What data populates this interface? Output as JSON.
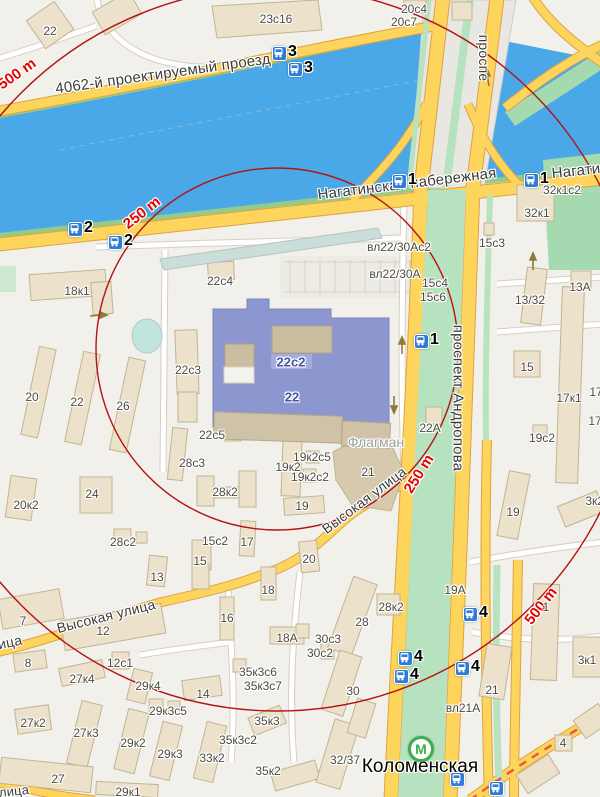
{
  "map": {
    "type": "city-map",
    "colors": {
      "water": "#4aa8e8",
      "land": "#f1f0ea",
      "road_major": "#fdd45c",
      "road_casing": "#dfa243",
      "building": "#ece2cb",
      "highlight_building": "#8d97cf",
      "green_area": "#a5d9af",
      "radius_circle": "#b31312",
      "distance_label": "#e10600",
      "bus_icon": "#2d7cd7",
      "metro_green": "#3aaf4a"
    },
    "metro": {
      "name": "Коломенская",
      "logo_letter": "М",
      "x": 421,
      "y": 749
    },
    "radius_rings_m": [
      250,
      500
    ],
    "bus_stops": [
      {
        "x": 272,
        "y": 46,
        "n": "3"
      },
      {
        "x": 288,
        "y": 62,
        "n": "3"
      },
      {
        "x": 68,
        "y": 222,
        "n": "2"
      },
      {
        "x": 108,
        "y": 235,
        "n": "2"
      },
      {
        "x": 392,
        "y": 174,
        "n": "1"
      },
      {
        "x": 524,
        "y": 173,
        "n": "1"
      },
      {
        "x": 414,
        "y": 334,
        "n": "1"
      },
      {
        "x": 398,
        "y": 651,
        "n": "4"
      },
      {
        "x": 394,
        "y": 669,
        "n": "4"
      },
      {
        "x": 463,
        "y": 607,
        "n": "4"
      },
      {
        "x": 455,
        "y": 661,
        "n": "4"
      },
      {
        "x": 450,
        "y": 772,
        "n": ""
      },
      {
        "x": 489,
        "y": 781,
        "n": ""
      }
    ],
    "labels": [
      {
        "t": "4062-й проектируемый проезд",
        "x": 163,
        "y": 74,
        "r": -8,
        "c": "st"
      },
      {
        "t": "Нагатинская набережная",
        "x": 407,
        "y": 184,
        "r": -7,
        "c": "st"
      },
      {
        "t": "Нагатинская",
        "x": 596,
        "y": 169,
        "r": -6,
        "c": "st"
      },
      {
        "t": "проспе",
        "x": 484,
        "y": 58,
        "r": 90,
        "c": "st",
        "s": 14
      },
      {
        "t": "проспект Андропова",
        "x": 458,
        "y": 398,
        "r": 90,
        "c": "st"
      },
      {
        "t": "Высокая улица",
        "x": 364,
        "y": 500,
        "r": -37,
        "c": "st",
        "s": 14
      },
      {
        "t": "Высокая улица",
        "x": 106,
        "y": 616,
        "r": -14,
        "c": "st",
        "s": 14
      },
      {
        "t": "ица",
        "x": 10,
        "y": 642,
        "r": -12,
        "c": "st",
        "s": 14
      },
      {
        "t": "лица",
        "x": 14,
        "y": 791,
        "r": -6,
        "c": "st",
        "s": 13
      },
      {
        "t": "Флагман",
        "x": 376,
        "y": 442,
        "r": 0,
        "c": "poi"
      },
      {
        "t": "Коломенская",
        "x": 420,
        "y": 767,
        "r": 0,
        "c": "metro"
      },
      {
        "t": "500 m",
        "x": 17,
        "y": 74,
        "r": -35,
        "c": "red"
      },
      {
        "t": "250 m",
        "x": 142,
        "y": 213,
        "r": -38,
        "c": "red"
      },
      {
        "t": "250 m",
        "x": 419,
        "y": 474,
        "r": -58,
        "c": "red"
      },
      {
        "t": "500 m",
        "x": 541,
        "y": 606,
        "r": -52,
        "c": "red"
      },
      {
        "t": "22с2",
        "x": 291,
        "y": 362,
        "r": 0,
        "c": "bb"
      },
      {
        "t": "22",
        "x": 292,
        "y": 397,
        "r": 0,
        "c": "bb"
      },
      {
        "t": "22",
        "x": 50,
        "y": 31,
        "r": 0,
        "c": "b"
      },
      {
        "t": "23с16",
        "x": 276,
        "y": 19,
        "r": 0,
        "c": "b"
      },
      {
        "t": "20с4",
        "x": 414,
        "y": 9,
        "r": 0,
        "c": "b"
      },
      {
        "t": "20с7",
        "x": 404,
        "y": 22,
        "r": 0,
        "c": "b"
      },
      {
        "t": "18к1",
        "x": 77,
        "y": 291,
        "r": 0,
        "c": "b"
      },
      {
        "t": "22с4",
        "x": 220,
        "y": 281,
        "r": 0,
        "c": "b"
      },
      {
        "t": "вл22/30Ас2",
        "x": 399,
        "y": 247,
        "r": 0,
        "c": "b"
      },
      {
        "t": "вл22/30А",
        "x": 395,
        "y": 274,
        "r": 0,
        "c": "b"
      },
      {
        "t": "15с4",
        "x": 435,
        "y": 283,
        "r": 0,
        "c": "b"
      },
      {
        "t": "15с6",
        "x": 433,
        "y": 297,
        "r": 0,
        "c": "b"
      },
      {
        "t": "15с3",
        "x": 492,
        "y": 243,
        "r": 0,
        "c": "b"
      },
      {
        "t": "32к1с2",
        "x": 562,
        "y": 190,
        "r": 0,
        "c": "b"
      },
      {
        "t": "32к1",
        "x": 537,
        "y": 213,
        "r": 0,
        "c": "b"
      },
      {
        "t": "13/32",
        "x": 530,
        "y": 300,
        "r": 0,
        "c": "b"
      },
      {
        "t": "13А",
        "x": 580,
        "y": 287,
        "r": 0,
        "c": "b"
      },
      {
        "t": "22с3",
        "x": 188,
        "y": 370,
        "r": 0,
        "c": "b"
      },
      {
        "t": "22А",
        "x": 430,
        "y": 428,
        "r": 0,
        "c": "b"
      },
      {
        "t": "22с5",
        "x": 212,
        "y": 435,
        "r": 0,
        "c": "b"
      },
      {
        "t": "28с3",
        "x": 192,
        "y": 463,
        "r": 0,
        "c": "b"
      },
      {
        "t": "28к2",
        "x": 225,
        "y": 492,
        "r": 0,
        "c": "b"
      },
      {
        "t": "19к2с5",
        "x": 312,
        "y": 457,
        "r": 0,
        "c": "b"
      },
      {
        "t": "19к2",
        "x": 288,
        "y": 467,
        "r": 0,
        "c": "b"
      },
      {
        "t": "19к2с2",
        "x": 310,
        "y": 477,
        "r": 0,
        "c": "b"
      },
      {
        "t": "21",
        "x": 368,
        "y": 472,
        "r": 0,
        "c": "b"
      },
      {
        "t": "19",
        "x": 302,
        "y": 506,
        "r": 0,
        "c": "b"
      },
      {
        "t": "28с2",
        "x": 123,
        "y": 542,
        "r": 0,
        "c": "b"
      },
      {
        "t": "15с2",
        "x": 215,
        "y": 541,
        "r": 0,
        "c": "b"
      },
      {
        "t": "17",
        "x": 247,
        "y": 542,
        "r": 0,
        "c": "b"
      },
      {
        "t": "15",
        "x": 200,
        "y": 561,
        "r": 0,
        "c": "b"
      },
      {
        "t": "13",
        "x": 157,
        "y": 577,
        "r": 0,
        "c": "b"
      },
      {
        "t": "20",
        "x": 309,
        "y": 559,
        "r": 0,
        "c": "b"
      },
      {
        "t": "18",
        "x": 268,
        "y": 590,
        "r": 0,
        "c": "b"
      },
      {
        "t": "16",
        "x": 227,
        "y": 618,
        "r": 0,
        "c": "b"
      },
      {
        "t": "7",
        "x": 23,
        "y": 621,
        "r": 0,
        "c": "b"
      },
      {
        "t": "12",
        "x": 103,
        "y": 631,
        "r": 0,
        "c": "b"
      },
      {
        "t": "8",
        "x": 28,
        "y": 663,
        "r": 0,
        "c": "b"
      },
      {
        "t": "12с1",
        "x": 120,
        "y": 663,
        "r": 0,
        "c": "b"
      },
      {
        "t": "27к4",
        "x": 82,
        "y": 679,
        "r": 0,
        "c": "b"
      },
      {
        "t": "29к4",
        "x": 148,
        "y": 686,
        "r": 0,
        "c": "b"
      },
      {
        "t": "14",
        "x": 203,
        "y": 694,
        "r": 0,
        "c": "b"
      },
      {
        "t": "29к3с5",
        "x": 168,
        "y": 711,
        "r": 0,
        "c": "b"
      },
      {
        "t": "27к2",
        "x": 33,
        "y": 723,
        "r": 0,
        "c": "b"
      },
      {
        "t": "27к3",
        "x": 86,
        "y": 733,
        "r": 0,
        "c": "b"
      },
      {
        "t": "29к2",
        "x": 133,
        "y": 743,
        "r": 0,
        "c": "b"
      },
      {
        "t": "29к3",
        "x": 170,
        "y": 754,
        "r": 0,
        "c": "b"
      },
      {
        "t": "33к2",
        "x": 212,
        "y": 758,
        "r": 0,
        "c": "b"
      },
      {
        "t": "27",
        "x": 58,
        "y": 779,
        "r": 0,
        "c": "b"
      },
      {
        "t": "29к1",
        "x": 128,
        "y": 792,
        "r": 0,
        "c": "b"
      },
      {
        "t": "18А",
        "x": 287,
        "y": 638,
        "r": 0,
        "c": "b"
      },
      {
        "t": "30с3",
        "x": 328,
        "y": 639,
        "r": 0,
        "c": "b"
      },
      {
        "t": "30с2",
        "x": 320,
        "y": 653,
        "r": 0,
        "c": "b"
      },
      {
        "t": "35к3с6",
        "x": 258,
        "y": 672,
        "r": 0,
        "c": "b"
      },
      {
        "t": "35к3с7",
        "x": 263,
        "y": 686,
        "r": 0,
        "c": "b"
      },
      {
        "t": "28к2",
        "x": 391,
        "y": 607,
        "r": 0,
        "c": "b"
      },
      {
        "t": "28",
        "x": 362,
        "y": 622,
        "r": 0,
        "c": "b"
      },
      {
        "t": "30",
        "x": 353,
        "y": 691,
        "r": 0,
        "c": "b"
      },
      {
        "t": "35к3",
        "x": 267,
        "y": 721,
        "r": 0,
        "c": "b"
      },
      {
        "t": "35к3с2",
        "x": 238,
        "y": 740,
        "r": 0,
        "c": "b"
      },
      {
        "t": "35к2",
        "x": 268,
        "y": 771,
        "r": 0,
        "c": "b"
      },
      {
        "t": "32/37",
        "x": 345,
        "y": 760,
        "r": 0,
        "c": "b"
      },
      {
        "t": "вл21А",
        "x": 463,
        "y": 708,
        "r": 0,
        "c": "b"
      },
      {
        "t": "19А",
        "x": 455,
        "y": 590,
        "r": 0,
        "c": "b"
      },
      {
        "t": "1",
        "x": 546,
        "y": 607,
        "r": 0,
        "c": "b"
      },
      {
        "t": "21",
        "x": 492,
        "y": 690,
        "r": 0,
        "c": "b"
      },
      {
        "t": "3к1",
        "x": 587,
        "y": 660,
        "r": 0,
        "c": "b"
      },
      {
        "t": "15",
        "x": 527,
        "y": 367,
        "r": 0,
        "c": "b"
      },
      {
        "t": "17к1",
        "x": 569,
        "y": 398,
        "r": 0,
        "c": "b"
      },
      {
        "t": "17к2",
        "x": 602,
        "y": 392,
        "r": 0,
        "c": "b"
      },
      {
        "t": "17",
        "x": 595,
        "y": 421,
        "r": 0,
        "c": "b"
      },
      {
        "t": "19с2",
        "x": 542,
        "y": 438,
        "r": 0,
        "c": "b"
      },
      {
        "t": "19",
        "x": 513,
        "y": 512,
        "r": 0,
        "c": "b"
      },
      {
        "t": "3к2с1",
        "x": 601,
        "y": 501,
        "r": 0,
        "c": "b"
      },
      {
        "t": "20к2",
        "x": 26,
        "y": 505,
        "r": 0,
        "c": "b"
      },
      {
        "t": "20",
        "x": 32,
        "y": 397,
        "r": 0,
        "c": "b"
      },
      {
        "t": "22",
        "x": 77,
        "y": 402,
        "r": 0,
        "c": "b"
      },
      {
        "t": "26",
        "x": 123,
        "y": 406,
        "r": 0,
        "c": "b"
      },
      {
        "t": "24",
        "x": 92,
        "y": 494,
        "r": 0,
        "c": "b"
      },
      {
        "t": "4",
        "x": 563,
        "y": 743,
        "r": 0,
        "c": "b"
      }
    ]
  }
}
